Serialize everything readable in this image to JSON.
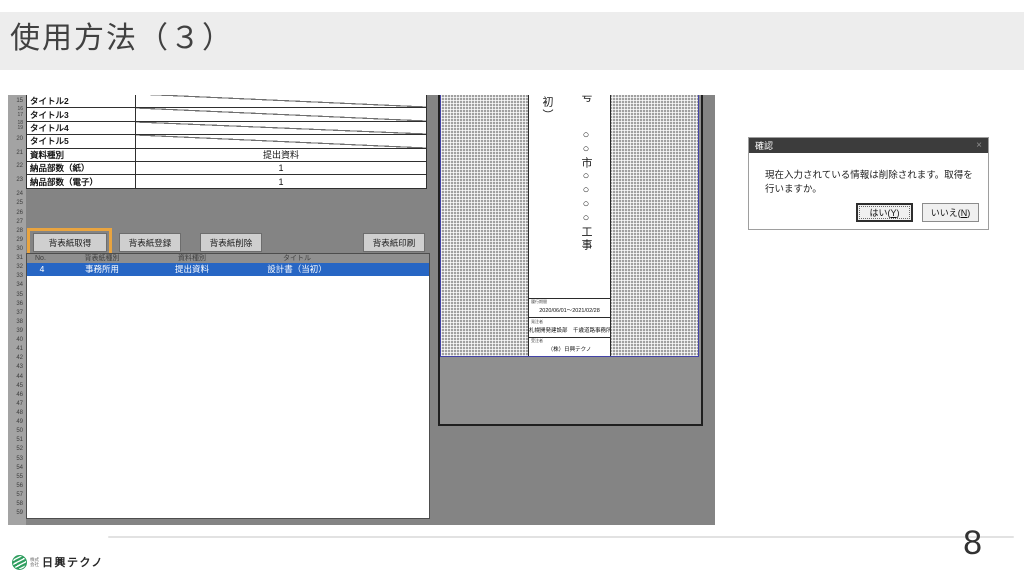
{
  "slide": {
    "title": "使用方法（３）",
    "page_number": "8",
    "logo": {
      "company_prefix": "株式\n会社",
      "company_name": "日興テクノ"
    }
  },
  "app": {
    "row_number_groups": [
      [
        "15"
      ],
      [
        "16",
        "17"
      ],
      [
        "18",
        "19"
      ],
      [
        "20"
      ],
      [
        "21"
      ],
      [
        "22"
      ],
      [
        "23"
      ]
    ],
    "row_numbers_lower": {
      "start": 24,
      "end": 59
    },
    "form_table": {
      "rows": [
        {
          "label": "タイトル2",
          "value": "",
          "slash": true
        },
        {
          "label": "タイトル3",
          "value": "",
          "slash": true
        },
        {
          "label": "タイトル4",
          "value": "",
          "slash": true
        },
        {
          "label": "タイトル5",
          "value": "",
          "slash": true
        },
        {
          "label": "資料種別",
          "value": "提出資料",
          "slash": false
        },
        {
          "label": "納品部数（紙）",
          "value": "1",
          "slash": false
        },
        {
          "label": "納品部数（電子）",
          "value": "1",
          "slash": false
        }
      ]
    },
    "buttons": [
      {
        "label": "背表紙取得",
        "highlighted": true
      },
      {
        "label": "背表紙登録",
        "highlighted": false
      },
      {
        "label": "背表紙削除",
        "highlighted": false
      },
      {
        "label": "背表紙印刷",
        "highlighted": false
      }
    ],
    "list": {
      "headers": [
        "No.",
        "背表紙種別",
        "資料種別",
        "タイトル"
      ],
      "selected_row": [
        "4",
        "事務所用",
        "提出資料",
        "設計書（当初）"
      ]
    },
    "preview": {
      "spine_text_top_right": "○号",
      "spine_text_main": "○○市○○○○工事",
      "spine_text_left": "当初）",
      "boxes": [
        {
          "label": "履行期間",
          "value": "2020/06/01～2021/02/28"
        },
        {
          "label": "発注者",
          "value": "札幌開発建設部　千歳道路事務所"
        },
        {
          "label": "受注者",
          "value": "（株）日興テクノ"
        }
      ]
    }
  },
  "dialog": {
    "title": "確認",
    "close_glyph": "×",
    "message": "現在入力されている情報は削除されます。取得を行いますか。",
    "yes_label": "はい(Y)",
    "no_label": "いいえ(N)"
  },
  "colors": {
    "highlight_orange": "#e9a43f",
    "selection_blue": "#2766c4",
    "dialog_titlebar": "#3c3c3c",
    "logo_green": "#2f9e5f",
    "pagebreak_blue": "#4343a8"
  }
}
